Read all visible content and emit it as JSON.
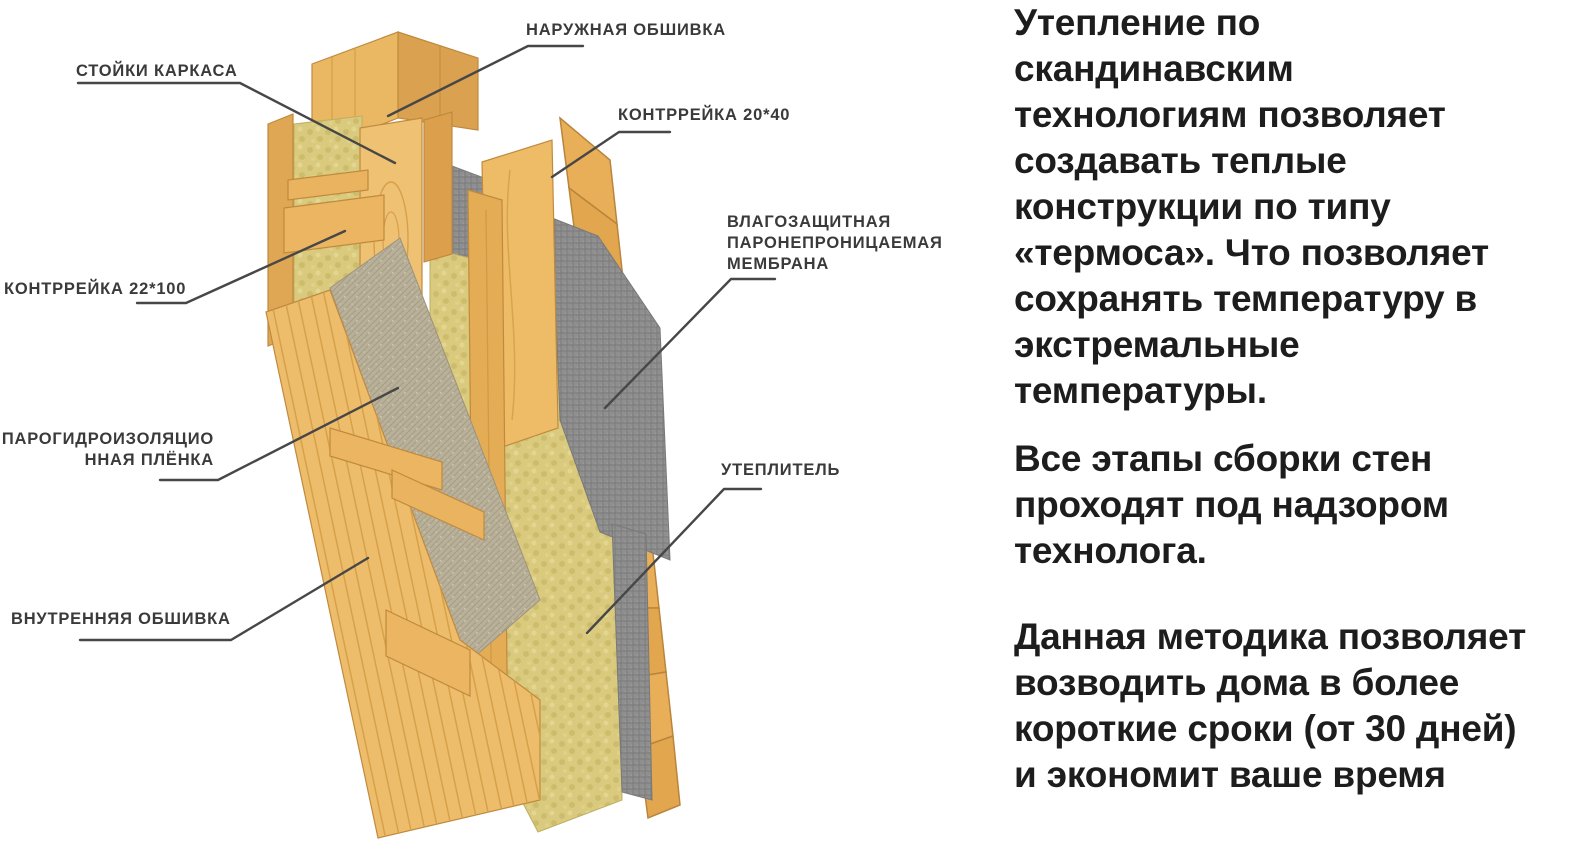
{
  "diagram": {
    "labels": [
      {
        "id": "frame-studs",
        "text": "СТОЙКИ КАРКАСА"
      },
      {
        "id": "outer-cladding",
        "text": "НАРУЖНАЯ ОБШИВКА"
      },
      {
        "id": "counter-batten-20x40",
        "text": "КОНТРРЕЙКА 20*40"
      },
      {
        "id": "counter-batten-22x100",
        "text": "КОНТРРЕЙКА 22*100"
      },
      {
        "id": "moisture-membrane",
        "text": "ВЛАГОЗАЩИТНАЯ\nПАРОНЕПРОНИЦАЕМАЯ\nМЕМБРАНА"
      },
      {
        "id": "vapor-film",
        "text": "ПАРОГИДРОИЗОЛЯЦИО\nННАЯ ПЛЁНКА"
      },
      {
        "id": "insulation",
        "text": "УТЕПЛИТЕЛЬ"
      },
      {
        "id": "inner-cladding",
        "text": "ВНУТРЕННЯЯ ОБШИВКА"
      }
    ]
  },
  "info_panel": {
    "paragraph_1": "Утепление по\nскандинавским\nтехнологиям позволяет\nсоздавать теплые\nконструкции по типу\n«термоса». Что позволяет\nсохранять температуру в\nэкстремальные\nтемпературы.",
    "paragraph_2": "Все этапы сборки стен\nпроходят под надзором\nтехнолога.",
    "paragraph_3": "Данная методика позволяет\nвозводить дома в более\nкороткие сроки (от 30 дней)\nи экономит ваше время"
  },
  "colors": {
    "background": "#ffffff",
    "label_text": "#3a3a3a",
    "leader_line": "#474747",
    "body_text": "#1d1d1d",
    "wood_light": "#eec06e",
    "wood_mid": "#e2a855",
    "wood_dark_edge": "#c08a3e",
    "insulation_fill": "#d9ca7e",
    "membrane_gray": "#8f8f8f",
    "vapor_film_beige": "#b9b09a"
  }
}
